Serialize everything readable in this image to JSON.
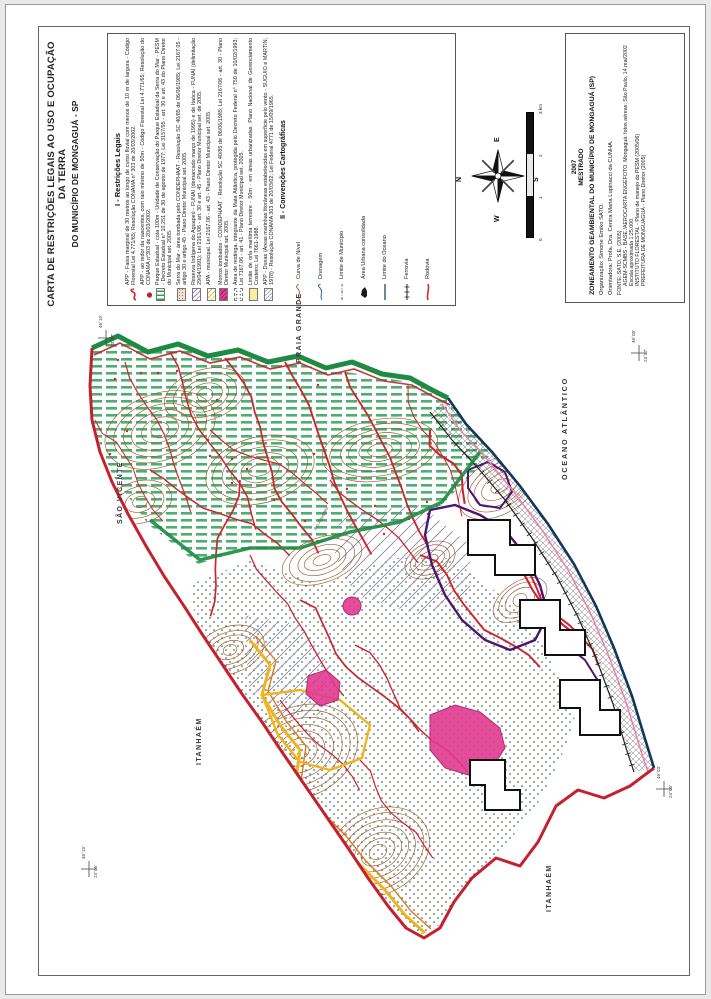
{
  "page": {
    "title_line1": "CARTA DE RESTRIÇÕES LEGAIS AO USO E OCUPAÇÃO DA TERRA",
    "title_line2": "DO MUNICÍPIO DE MONGAGUÁ - SP"
  },
  "legend": {
    "title": "I - Restrições Legais",
    "items": [
      {
        "symbol": "app-river-line",
        "text": "APP - Faixa marginal de 30 metros ao longo de curso fluvial com menos de 10 m de largura - Código Florestal Lei 4.771/65; Resolução CONAMA n° 303 de 20/03/2002."
      },
      {
        "symbol": "app-spring-dot",
        "text": "APP - ao redor da nascentes, com raio mínimo de 50m - Código Florestal Lei 4.771/65; Resolução do CONAMA n°303 de 20/03/2002."
      },
      {
        "symbol": "parque-estadual-bars",
        "text": "Parque Estadual - cota 100m - Unidade de Conservação do Parque Estadual da Serra do Mar - PESM - Decreto Estadual n° 10.251 de 30 de agosto de 1977; Lei 3157/95 - art. 30 e art. 43 do Plano Diretor do Municipal set. 2005."
      },
      {
        "symbol": "serra-tombada-speckle",
        "text": "Serra do Mar - área tombada pelo CONDEPHAAT - Resolução SC 40/85 de 06/06/1985; Lei 2167.05 - artigo 30 e artigo 45 - Plano Diretor Municipal set. 2005."
      },
      {
        "symbol": "reserva-indigena-hatch",
        "text": "Reserva Indígena do Aguapeú - FUNAI (demarcado março de 1995) e de Itaóca - FUNAI (delimitação 29/04/1991); Lei 2161/06 - art. 30 e art. 45 - Plano Diretor Municipal set. de 2005."
      },
      {
        "symbol": "apa-municipal-hatch",
        "text": "APA - municipal. Lei 2167.06 - art. 43 - Plano Diretor Municipal set. 2005."
      },
      {
        "symbol": "morros-tombados-fill",
        "text": "Morros tombados - CONDEPHAAT - Resolução SC 40/85 de 06/06/1985; Lei 2167/06 - art. 30 - Plano Diretor Municipal set. 2005."
      },
      {
        "symbol": "restinga-dots",
        "text": "Área de restinga, integrante da Mata Atlântica, protegida pelo Decreto Federal n° 750 de 10/02/1993; Lei 7167.06 - art. 41 - Plano Diretor Municipal set. 2005."
      },
      {
        "symbol": "orla-maritima-fill",
        "text": "Limite de orla marítima terrestre - 50m - em áreas urbanizadas. Plano Nacional de Gerenciamento Costeiro; Lei 7661-1988."
      },
      {
        "symbol": "dunas-hatch",
        "text": "APP - Dunas (Áreas marinhas litorâneas estabelecidas em superfície pelo vento - SUGUIO e MARTIN, 1978) - Resolução CONAMA 303 de 20/03/02; Lei Federal 4771 de 15/09/1965."
      }
    ],
    "conventions_title": "II - Convenções Cartográficas",
    "conventions": [
      {
        "symbol": "contour-line",
        "label": "Curva de Nível"
      },
      {
        "symbol": "drainage-line",
        "label": "Drenagem"
      },
      {
        "symbol": "municipality-limit-line",
        "label": "Limite de Município"
      },
      {
        "symbol": "urban-area-blob",
        "label": "Área Urbana consolidada"
      },
      {
        "symbol": "ocean-limit-line",
        "label": "Limite do Oceano"
      },
      {
        "symbol": "railway-line",
        "label": "Ferrovia"
      },
      {
        "symbol": "highway-line",
        "label": "Rodovia"
      }
    ]
  },
  "info_box": {
    "year": "2007",
    "program": "MESTRADO",
    "title": "ZONEAMENTO GEAMBIENTAL DO MUNICÍPIO DE MONGAGUÁ (SP)",
    "organization": "Organização: Simone Emiko SATO.",
    "advisor": "Orientadora: Profa. Dra. Cenira Maria Lupinacci da CUNHA.",
    "sources": [
      "FONTE: SATO, S.E. (2005)",
      "AGEM-SCMBS - BASE /AEROCARTA ENGEFOTO. Mongaguá: fotos aéreas: São Paulo, 14.mai/2002 Escala aproximada 1:25.000.",
      "INSTITUTO FLORESTAL - Plano de manejo do PESM (2005/06)",
      "PREFEITURA DE MONGUAGUÁ - Plano Diretor (2005)"
    ]
  },
  "compass": {
    "n": "N",
    "s": "S",
    "e": "E",
    "w": "W"
  },
  "scale_bar": {
    "ticks": [
      "0",
      "1",
      "2",
      "3 km"
    ]
  },
  "map": {
    "labels": {
      "north_neighbor": "SÃO VICENTE",
      "northeast_neighbor": "PRAIA GRANDE",
      "ocean": "OCEANO ATLÂNTICO",
      "west_neighbor": "ITANHAÉM",
      "south_neighbor": "ITANHAÉM",
      "river": "Rio Aguapeú"
    },
    "coords": [
      {
        "lon": "46°15'",
        "lat": "23°57'"
      },
      {
        "lon": "46°08'",
        "lat": "23°57'"
      },
      {
        "lon": "46°03'",
        "lat": "24°06'"
      },
      {
        "lon": "46°15'",
        "lat": "24°06'"
      }
    ]
  },
  "colors": {
    "municipal_boundary_red": "#c4202e",
    "serra_tombada_green": "#1f8a44",
    "coastline_navy": "#12365c",
    "contour_brown": "#9a5b30",
    "morro_purple": "#4d1570",
    "morros_tombados_pink": "#e23a8e",
    "apa_yellow": "#f0b41c",
    "orla_pink": "#ef7fae"
  }
}
